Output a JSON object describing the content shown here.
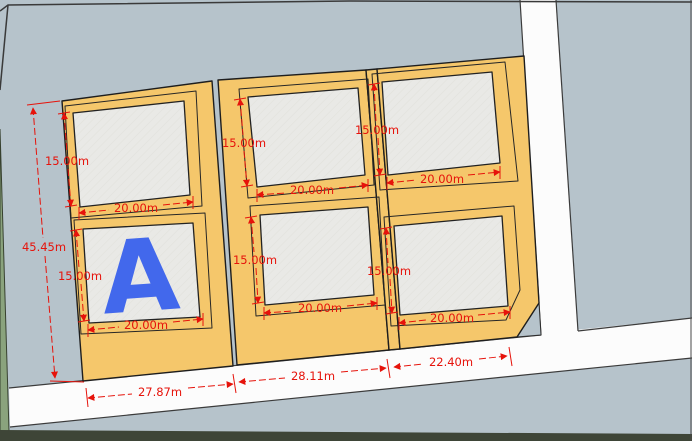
{
  "scene": {
    "type": "cad-site-plan-viewport",
    "marker": {
      "label": "A"
    },
    "dims": {
      "lot_height": "15.00m",
      "lot_width": "20.00m",
      "total_depth": "45.45m",
      "frontage_1": "27.87m",
      "frontage_2": "28.11m",
      "frontage_3": "22.40m"
    },
    "colors": {
      "background": "#B6C3CB",
      "plot_fill": "#F5C76B",
      "building_fill": "#E9E9E6",
      "road_fill": "#FCFCFC",
      "dimension_red": "#E6130B",
      "marker_blue": "#4268EC",
      "verge_green": "#8AA37D",
      "edge_dark": "#1E1E1E",
      "bottom_strip": "#3E4537"
    }
  }
}
